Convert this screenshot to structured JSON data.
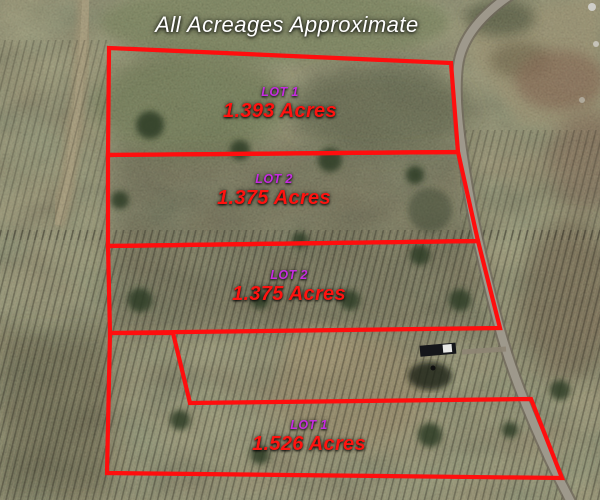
{
  "title": "All Acreages Approximate",
  "colors": {
    "boundary": "#ff0e0e",
    "lot_name": "#c62ce0",
    "acreage": "#ff1310",
    "title": "#ffffff"
  },
  "lots": [
    {
      "name": "LOT 1",
      "acreage": "1.393 Acres"
    },
    {
      "name": "LOT 2",
      "acreage": "1.375 Acres"
    },
    {
      "name": "LOT 2",
      "acreage": "1.375 Acres"
    },
    {
      "name": "LOT 1",
      "acreage": "1.526 Acres"
    }
  ]
}
